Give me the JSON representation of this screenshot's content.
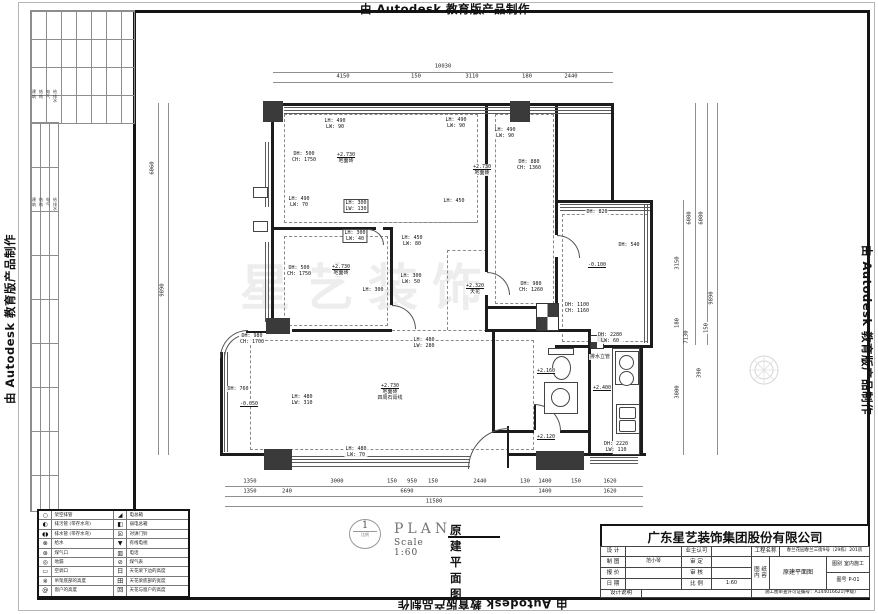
{
  "watermark": {
    "text": "由 Autodesk 教育版产品制作"
  },
  "brand_watermark": {
    "text": "星艺装饰"
  },
  "sheet": {
    "disciplines": [
      "建筑",
      "结构",
      "电气",
      "给排水"
    ]
  },
  "plan_title": {
    "number": "1",
    "sub": "比例",
    "en": "PLAN",
    "cn": "原建平面图",
    "scale": "Scale 1:60"
  },
  "title_block": {
    "company": "广东星艺装饰集团股份有限公司",
    "design_label": "设 计",
    "owner_label": "业主认可",
    "project_label": "工程名称",
    "project_value": "春兰花园春兰三街9号（29栋）201房",
    "draft_label": "制 图",
    "draft_value": "范小琴",
    "approve_label": "审 定",
    "quote_label": "报 价",
    "check_label": "审 核",
    "date_label": "日 期",
    "scale_label": "比 例",
    "scale_value": "1:60",
    "sheet_label": "图 纸",
    "content_label": "内 容",
    "content_value": "原建平面图",
    "category_label": "图别",
    "category_value": "室内施工",
    "number_label": "图号",
    "number_value": "P-01",
    "note_label": "设计说明",
    "permit_value": "施工图审查许可证编号：A144016621(甲级)"
  },
  "legend": {
    "rows": [
      {
        "ls": "○",
        "ln": "pipe-icon",
        "lt": "架空排管",
        "rs": "◢",
        "rn": "power-box-icon",
        "rt": "电总箱"
      },
      {
        "ls": "◐",
        "ln": "sewage-pipe-icon",
        "lt": "排污管 (带存水弯)",
        "rs": "◧",
        "rn": "lv-power-box-icon",
        "rt": "弱电总箱"
      },
      {
        "ls": "◖◗",
        "ln": "drain-pipe-icon",
        "lt": "排水管 (带存水弯)",
        "rs": "☒",
        "rn": "intercom-icon",
        "rt": "对讲门铃"
      },
      {
        "ls": "⊗",
        "ln": "water-supply-icon",
        "lt": "给水",
        "rs": "▼",
        "rn": "cable-tv-icon",
        "rt": "有线电视"
      },
      {
        "ls": "⊛",
        "ln": "gas-outlet-icon",
        "lt": "煤气口",
        "rs": "▥",
        "rn": "telephone-icon",
        "rt": "电话"
      },
      {
        "ls": "◎",
        "ln": "floor-drain-icon",
        "lt": "地漏",
        "rs": "⊘",
        "rn": "gas-meter-icon",
        "rt": "煤气表"
      },
      {
        "ls": "▭",
        "ln": "ac-outlet-icon",
        "lt": "空调口",
        "rs": "日",
        "rn": "mark-icon",
        "rt": "天花梁下边的高度"
      },
      {
        "ls": "※",
        "ln": "mark-icon",
        "lt": "吊架底部的高度",
        "rs": "田",
        "rn": "mark-icon",
        "rt": "天花梁底部的宽度"
      },
      {
        "ls": "@",
        "ln": "mark-icon",
        "lt": "窗户的高度",
        "rs": "回",
        "rn": "mark-icon",
        "rt": "天花与窗户的高度"
      }
    ]
  },
  "plan": {
    "annotations": [
      {
        "x": 304,
        "y": 157,
        "lines": [
          "DH: 500",
          "CH: 1750"
        ]
      },
      {
        "x": 346,
        "y": 158,
        "u": true,
        "lines": [
          "+2.730",
          "地面砖"
        ]
      },
      {
        "x": 335,
        "y": 124,
        "lines": [
          "LH: 490",
          "LW: 90"
        ]
      },
      {
        "x": 456,
        "y": 123,
        "lines": [
          "LH: 490",
          "LW: 90"
        ]
      },
      {
        "x": 505,
        "y": 133,
        "lines": [
          "LH: 490",
          "LW: 90"
        ]
      },
      {
        "x": 299,
        "y": 202,
        "lines": [
          "LH: 490",
          "LW: 70"
        ]
      },
      {
        "x": 356,
        "y": 206,
        "box": true,
        "lines": [
          "LH: 300",
          "LW: 130"
        ]
      },
      {
        "x": 355,
        "y": 236,
        "box": true,
        "lines": [
          "LH: 300",
          "LW: 40"
        ]
      },
      {
        "x": 299,
        "y": 271,
        "lines": [
          "DH: 500",
          "CH: 1750"
        ]
      },
      {
        "x": 341,
        "y": 270,
        "u": true,
        "lines": [
          "+2.730",
          "地面砖"
        ]
      },
      {
        "x": 411,
        "y": 279,
        "lines": [
          "LH: 300",
          "LW: 50"
        ]
      },
      {
        "x": 373,
        "y": 290,
        "lines": [
          "LH: 300"
        ]
      },
      {
        "x": 412,
        "y": 241,
        "lines": [
          "LH: 450",
          "LW: 80"
        ]
      },
      {
        "x": 454,
        "y": 201,
        "lines": [
          "LH: 450"
        ]
      },
      {
        "x": 482,
        "y": 170,
        "u": true,
        "lines": [
          "+2.730",
          "地面砖"
        ]
      },
      {
        "x": 529,
        "y": 165,
        "lines": [
          "DH: 880",
          "CH: 1360"
        ]
      },
      {
        "x": 475,
        "y": 289,
        "u": true,
        "lines": [
          "+2.320",
          "天花"
        ]
      },
      {
        "x": 531,
        "y": 287,
        "lines": [
          "DH: 980",
          "CH: 1260"
        ]
      },
      {
        "x": 597,
        "y": 212,
        "lines": [
          "DH: 820"
        ]
      },
      {
        "x": 629,
        "y": 245,
        "lines": [
          "DH: 540"
        ]
      },
      {
        "x": 597,
        "y": 265,
        "u": true,
        "lines": [
          "-0.100"
        ]
      },
      {
        "x": 577,
        "y": 308,
        "lines": [
          "DH: 1100",
          "CH: 1160"
        ]
      },
      {
        "x": 610,
        "y": 338,
        "lines": [
          "DH: 2280",
          "LW: 60"
        ]
      },
      {
        "x": 600,
        "y": 357,
        "lines": [
          "排水立管"
        ]
      },
      {
        "x": 546,
        "y": 371,
        "u": true,
        "lines": [
          "+2.160"
        ]
      },
      {
        "x": 602,
        "y": 388,
        "u": true,
        "lines": [
          "+2.400"
        ]
      },
      {
        "x": 546,
        "y": 437,
        "u": true,
        "lines": [
          "+2.120"
        ]
      },
      {
        "x": 616,
        "y": 447,
        "lines": [
          "DH: 2220",
          "LW: 110"
        ]
      },
      {
        "x": 252,
        "y": 339,
        "lines": [
          "DH: 980",
          "CH: 1700"
        ]
      },
      {
        "x": 238,
        "y": 389,
        "lines": [
          "DH: 760"
        ]
      },
      {
        "x": 249,
        "y": 404,
        "u": true,
        "lines": [
          "-0.050"
        ]
      },
      {
        "x": 302,
        "y": 400,
        "lines": [
          "LH: 480",
          "LW: 310"
        ]
      },
      {
        "x": 424,
        "y": 343,
        "lines": [
          "LH: 480",
          "LW: 280"
        ]
      },
      {
        "x": 356,
        "y": 452,
        "lines": [
          "LH: 480",
          "LW: 70"
        ]
      },
      {
        "x": 390,
        "y": 392,
        "u": true,
        "lines": [
          "+2.730",
          "地面砖",
          "四周石膏线"
        ]
      }
    ],
    "dims": [
      {
        "t": "10030",
        "x": 443,
        "y": 67
      },
      {
        "t": "4150",
        "x": 343,
        "y": 77
      },
      {
        "t": "150",
        "x": 416,
        "y": 77
      },
      {
        "t": "3110",
        "x": 472,
        "y": 77
      },
      {
        "t": "180",
        "x": 527,
        "y": 77
      },
      {
        "t": "2440",
        "x": 571,
        "y": 77
      },
      {
        "t": "1350",
        "x": 250,
        "y": 482
      },
      {
        "t": "3000",
        "x": 337,
        "y": 482
      },
      {
        "t": "150",
        "x": 392,
        "y": 482
      },
      {
        "t": "950",
        "x": 412,
        "y": 482
      },
      {
        "t": "150",
        "x": 433,
        "y": 482
      },
      {
        "t": "2440",
        "x": 480,
        "y": 482
      },
      {
        "t": "130",
        "x": 525,
        "y": 482
      },
      {
        "t": "1400",
        "x": 545,
        "y": 482
      },
      {
        "t": "150",
        "x": 576,
        "y": 482
      },
      {
        "t": "1620",
        "x": 610,
        "y": 482
      },
      {
        "t": "1350",
        "x": 250,
        "y": 492
      },
      {
        "t": "240",
        "x": 287,
        "y": 492
      },
      {
        "t": "6690",
        "x": 407,
        "y": 492
      },
      {
        "t": "1400",
        "x": 545,
        "y": 492
      },
      {
        "t": "1620",
        "x": 610,
        "y": 492
      },
      {
        "t": "11580",
        "x": 434,
        "y": 502
      },
      {
        "t": "6060",
        "x": 153,
        "y": 168,
        "v": true
      },
      {
        "t": "9890",
        "x": 163,
        "y": 290,
        "v": true
      },
      {
        "t": "6080",
        "x": 690,
        "y": 218,
        "v": true
      },
      {
        "t": "6080",
        "x": 702,
        "y": 218,
        "v": true
      },
      {
        "t": "3150",
        "x": 678,
        "y": 263,
        "v": true
      },
      {
        "t": "9890",
        "x": 712,
        "y": 298,
        "v": true
      },
      {
        "t": "180",
        "x": 678,
        "y": 323,
        "v": true
      },
      {
        "t": "150",
        "x": 707,
        "y": 328,
        "v": true
      },
      {
        "t": "7130",
        "x": 687,
        "y": 337,
        "v": true
      },
      {
        "t": "390",
        "x": 700,
        "y": 373,
        "v": true
      },
      {
        "t": "3800",
        "x": 678,
        "y": 392,
        "v": true
      }
    ]
  }
}
